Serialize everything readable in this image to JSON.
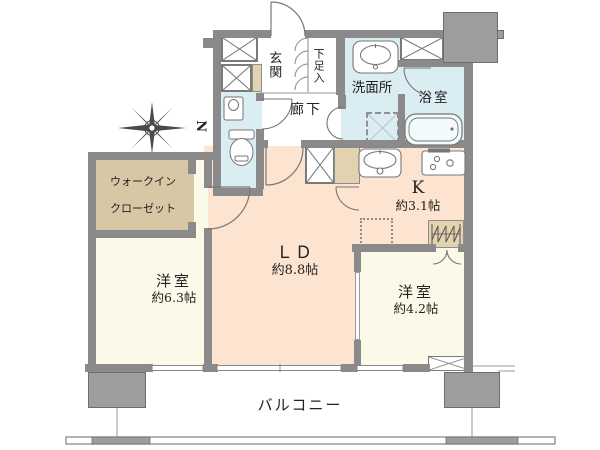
{
  "plan_title": "floor-plan",
  "compass": {
    "label": "N"
  },
  "rooms": {
    "ld": {
      "label": "ＬＤ",
      "area": "約8.8帖"
    },
    "kitchen": {
      "label": "K",
      "area": "約3.1帖"
    },
    "bedroom1": {
      "label": "洋室",
      "area": "約6.3帖"
    },
    "bedroom2": {
      "label": "洋室",
      "area": "約4.2帖"
    },
    "wic": {
      "label_line1": "ウォークイン",
      "label_line2": "クローゼット"
    },
    "entrance": {
      "label": "玄関"
    },
    "shoe_cabinet": {
      "label": "下足入"
    },
    "hallway": {
      "label": "廊下"
    },
    "washroom": {
      "label": "洗面所"
    },
    "bathroom": {
      "label": "浴室"
    },
    "balcony": {
      "label": "バルコニー"
    }
  },
  "icons": {
    "compass": "compass-star",
    "bathtub": "bathtub-icon",
    "toilet": "toilet-icon",
    "washbasin": "washbasin-icon",
    "kitchen_sink": "kitchen-sink-icon",
    "stove": "stove-icon",
    "washer_space": "washing-machine-space",
    "fridge_space": "refrigerator-space",
    "hanger_pipe": "hanger-pipe-icon",
    "pipe_space": "pipe-space-x",
    "escape_hatch": "escape-hatch-x"
  },
  "colors": {
    "wall": "#8a8a8a",
    "pillar": "#9d9d9d",
    "peach": "#fce4d1",
    "cream": "#fbfae8",
    "blue": "#d9edf2",
    "tan": "#d8c7a5",
    "doorBeige": "#e2d2b0",
    "line": "#777777"
  }
}
